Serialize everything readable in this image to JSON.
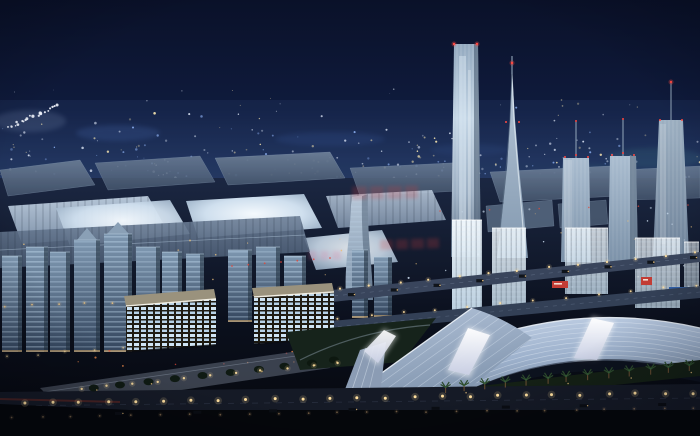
{
  "scene": {
    "type": "architectural night rendering (aerial view)",
    "description": "Masterplan visualization of an exhibition city at night: rows of exhibition halls with glowing skylit roofs on the left, a cluster of illuminated supertall towers with red aviation beacons on the right, mid-rise office blocks with lit floors in the lower left, two glowing grid-facade slab buildings, and a long curved glass canopy over a palm-lined boulevard in the foreground. Distant city lights fill the horizon under a dark navy sky.",
    "visible_text": "none — only faint illegible red watermark stamps over the hall roofs",
    "watermark_note": "illegible faint red stamp repeated three times"
  },
  "palette": {
    "sky_top": "#0a1129",
    "sky_horizon": "#24375e",
    "ground_dark": "#0b101d",
    "hall_roof": "#b6c6d8",
    "hall_roof_glow": "#f4f9fd",
    "tower_facade": "#b9cede",
    "beacon_red": "#ff4a42",
    "window_warm": "#ecc27c",
    "window_cool": "#cfe0f2",
    "distant_warm": "#f3e2ae",
    "distant_cool": "#dbe4f4",
    "distant_blue": "#86a8e8",
    "street_lamp": "#ffdf9e",
    "taillight_red": "#e04838",
    "canopy_top": "#c6d4e8",
    "canopy_bottom": "#76889f",
    "sail_white": "#ffffff",
    "lawn_green": "#16231b",
    "palm_green": "#2c4a2c",
    "plaza_concrete": "#6b7586",
    "billboard_red": "#c23c35",
    "billboard_blue": "#2f5fa8",
    "watermark_red": "#ce3e3e"
  },
  "inventory": {
    "supertall_towers": 5,
    "spire_towers": 1,
    "twisted_towers": 1,
    "glowing_hall_roofs": 4,
    "glowing_grid_buildings": 2,
    "canopy_glow_sails": 3,
    "watermark_stamps": 3
  }
}
